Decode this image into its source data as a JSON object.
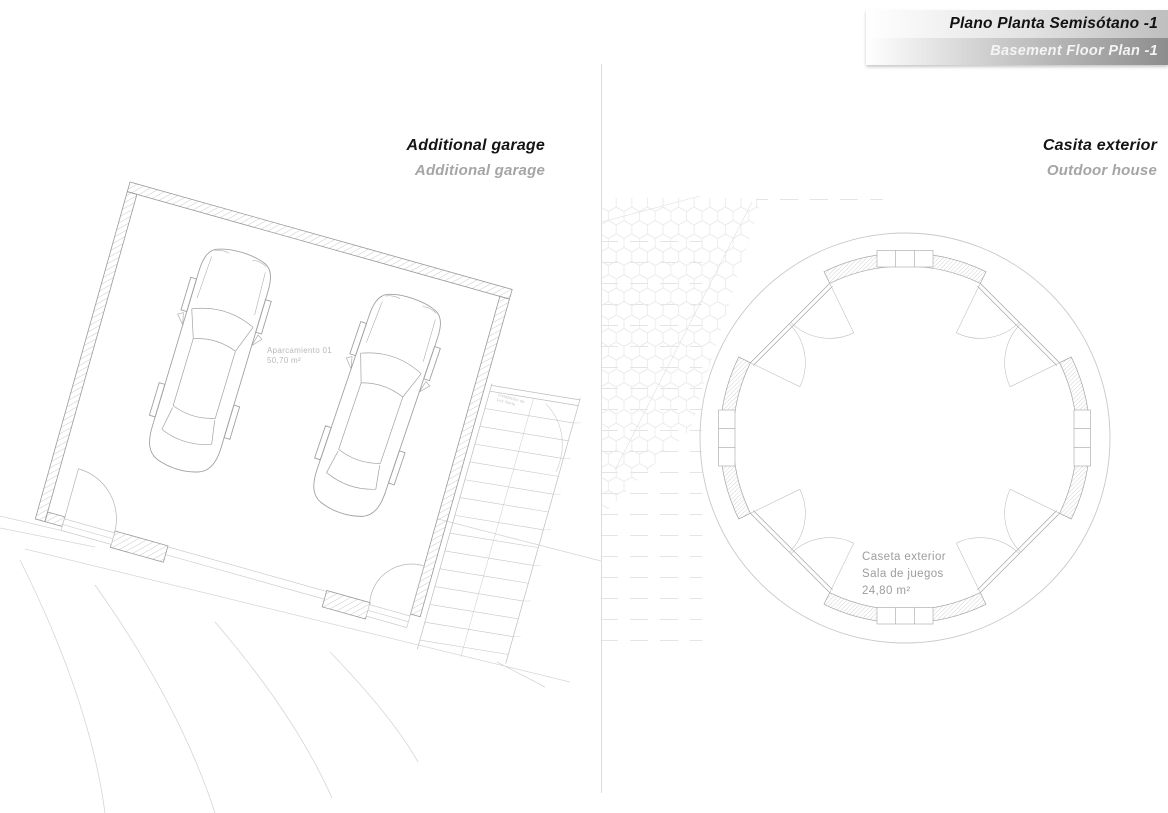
{
  "title_block": {
    "title_es": "Plano Planta Semisótano -1",
    "title_en": "Basement Floor Plan -1"
  },
  "sections": {
    "garage": {
      "heading": "Additional garage",
      "subheading": "Additional garage",
      "room_label": "Aparcamiento 01",
      "room_area": "50,70 m²",
      "stairs_note_line1": "Instalación de",
      "stairs_note_line2": "Luz Norte"
    },
    "outdoor_house": {
      "heading": "Casita exterior",
      "subheading": "Outdoor house",
      "room_label": "Caseta exterior",
      "room_use": "Sala de juegos",
      "room_area": "24,80 m²"
    }
  },
  "colors": {
    "heading_text": "#151515",
    "subheading_text": "#a5a5a5",
    "title_gradient_end": "#8d8d8d",
    "drawing_line": "#a8a8a8",
    "hatch_line": "#bcbcbc",
    "terrain_line": "#d6d6d6"
  }
}
